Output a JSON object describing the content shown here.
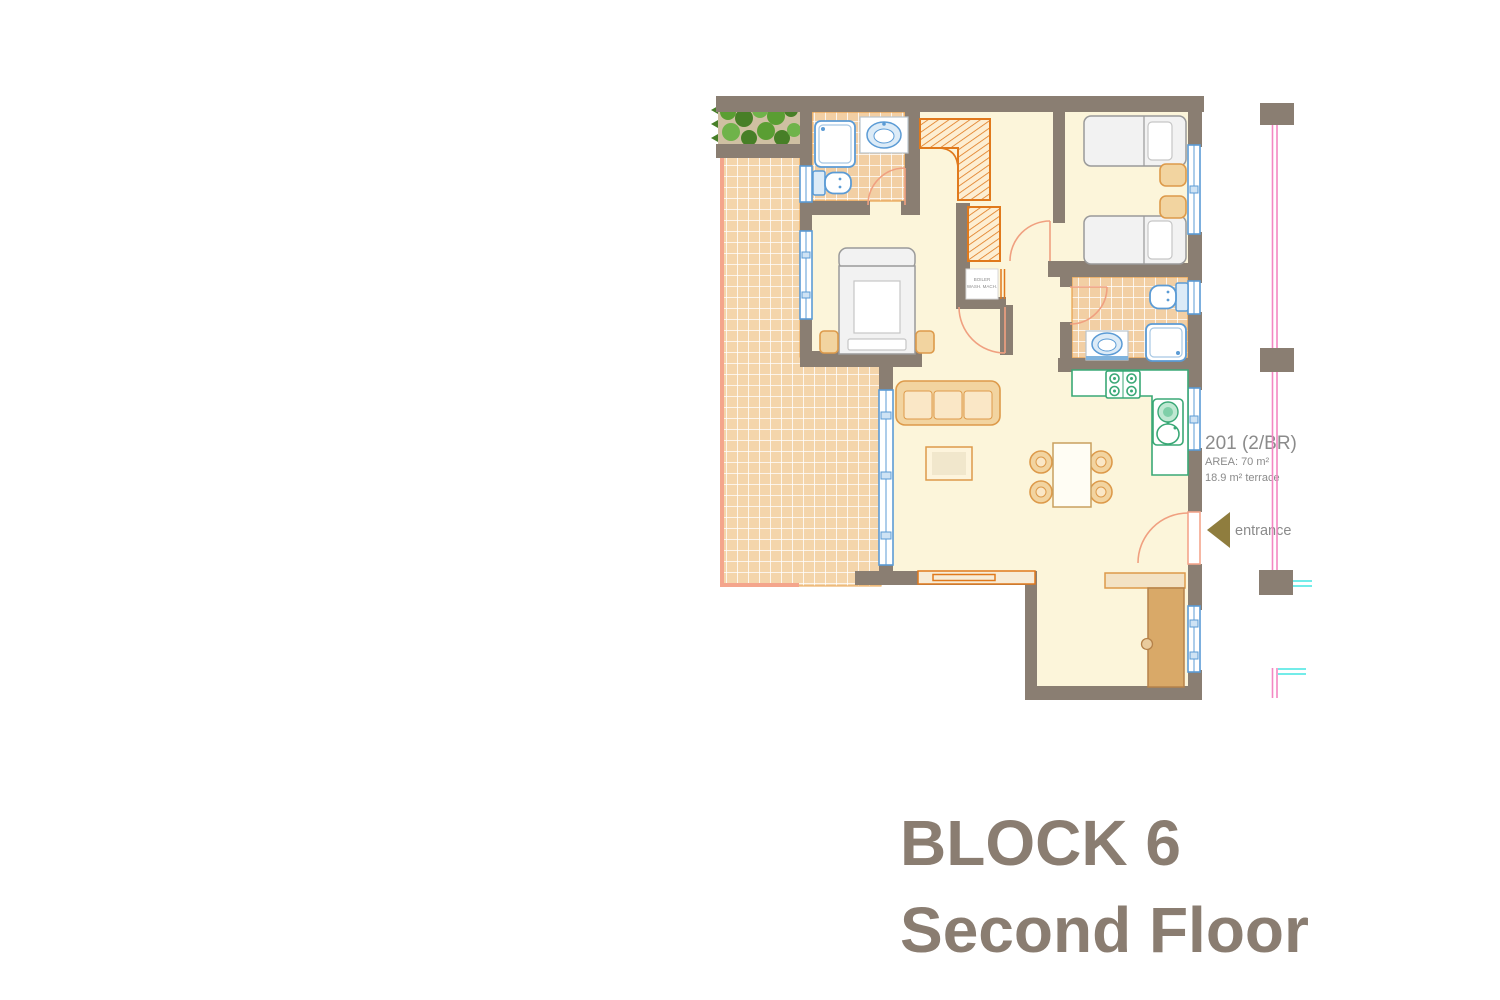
{
  "title": {
    "line1": "BLOCK 6",
    "line2": "Second Floor"
  },
  "unit": {
    "number": "201 (2/BR)",
    "area": "AREA: 70 m²",
    "terrace": "18.9 m² terrace",
    "entrance_label": "entrance"
  },
  "utility_closet": {
    "line1": "BOILER",
    "line2": "WASH. MACH."
  },
  "icons": {
    "entrance_arrow": "left-pointing-triangle"
  },
  "palette": {
    "wall": "#8a7e72",
    "floor": "#fcf5da",
    "tile": "#f2cfa4",
    "terrTile": "#f4d5ab",
    "tileBorder": "#e8a04a",
    "salmon": "#f4a58c",
    "door": "#f0a080",
    "blue": "#5b9bd5",
    "blueFill": "#dcebf7",
    "green": "#3aa876",
    "greenFill": "#bfe8d2",
    "tan": "#f2d4a0",
    "tanStroke": "#dd9a4a",
    "woodDark": "#d9a968",
    "woodStroke": "#b5824a",
    "bedStroke": "#9a9a9a",
    "orange": "#e0791c",
    "orangeFill": "#fdeed2",
    "textGray": "#8b8b8b",
    "titleColor": "#8a7d71",
    "pink": "#f387c3",
    "cyan": "#45e5e2",
    "plantBg": "#cfc0a2",
    "plant1": "#5a9e33",
    "plant2": "#477f27",
    "plant3": "#6fb34a",
    "arrow": "#8f7d3e"
  }
}
